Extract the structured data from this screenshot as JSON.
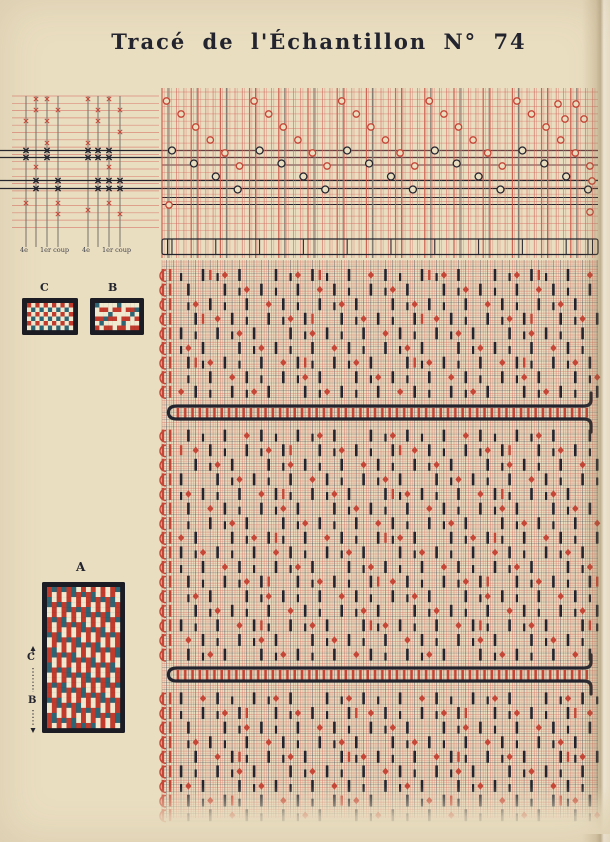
{
  "title": "Tracé de l'Échantillon N° 74",
  "threading": {
    "labels": [
      "4e",
      "1er coup",
      "4e",
      "1er coup"
    ]
  },
  "swatches": {
    "a": {
      "label": "A"
    },
    "b": {
      "label": "B"
    },
    "c": {
      "label": "C"
    },
    "side_markers": {
      "c": "C",
      "b": "B"
    }
  },
  "colors": {
    "paper": "#eadec1",
    "ink_dark": "#23242e",
    "ink_red": "#c54536",
    "red_line": "#d4685c",
    "gray_line": "#76716a",
    "swatch_red": "#c23a2c",
    "swatch_blue": "#2d6575",
    "swatch_cream": "#f0e8cf",
    "swatch_border": "#1b1c24"
  }
}
